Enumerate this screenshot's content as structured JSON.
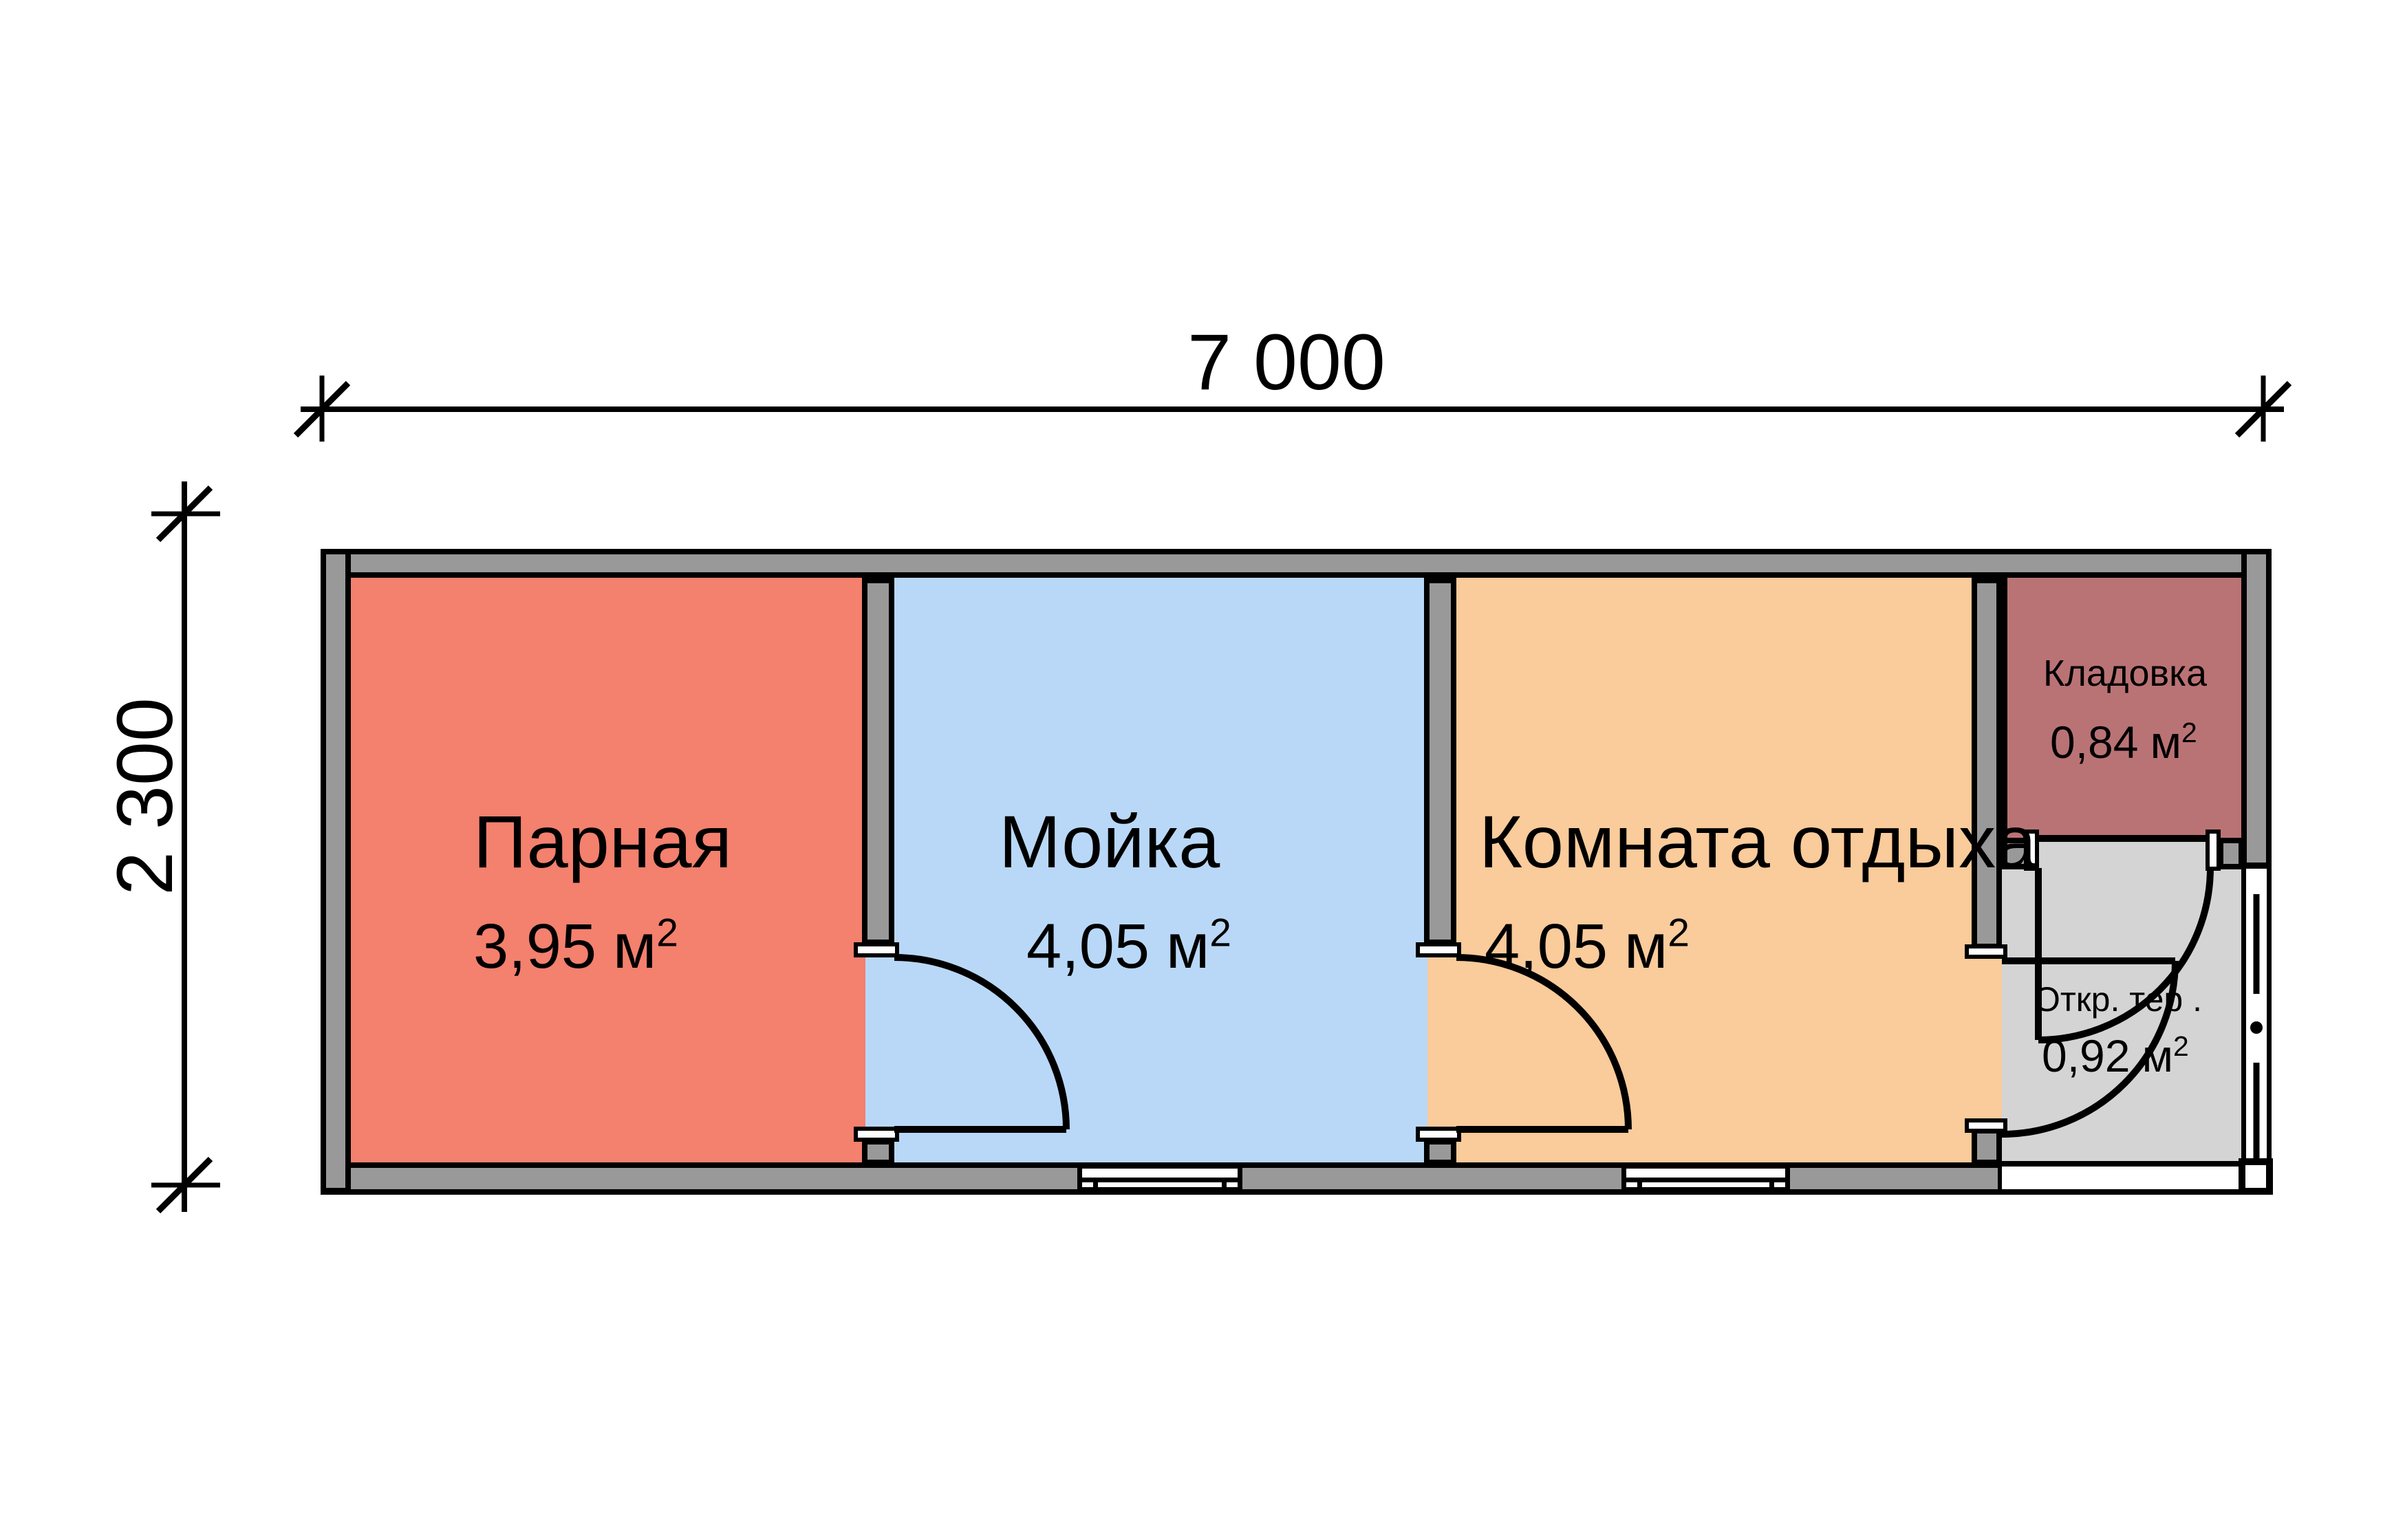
{
  "plan": {
    "dim_width": "7 000",
    "dim_height": "2 300"
  },
  "rooms": [
    {
      "name": "Парная",
      "area_value": "3,95",
      "area_unit": "м",
      "area_exp": "2",
      "fill": "#F4806E"
    },
    {
      "name": "Мойка",
      "area_value": "4,05",
      "area_unit": "м",
      "area_exp": "2",
      "fill": "#B9D8F8"
    },
    {
      "name": "Комната отдыха",
      "area_value": "4,05",
      "area_unit": "м",
      "area_exp": "2",
      "fill": "#FACB9B"
    },
    {
      "name": "Кладовка",
      "area_value": "0,84",
      "area_unit": "м",
      "area_exp": "2",
      "fill": "#BA7375"
    },
    {
      "name": "Откр. тер .",
      "area_value": "0,92",
      "area_unit": "м",
      "area_exp": "2",
      "fill": "#D4D4D4"
    }
  ],
  "colors": {
    "wall": "#999999",
    "line": "#000000",
    "window_fill": "#FFFFFF",
    "background": "#FFFFFF"
  }
}
